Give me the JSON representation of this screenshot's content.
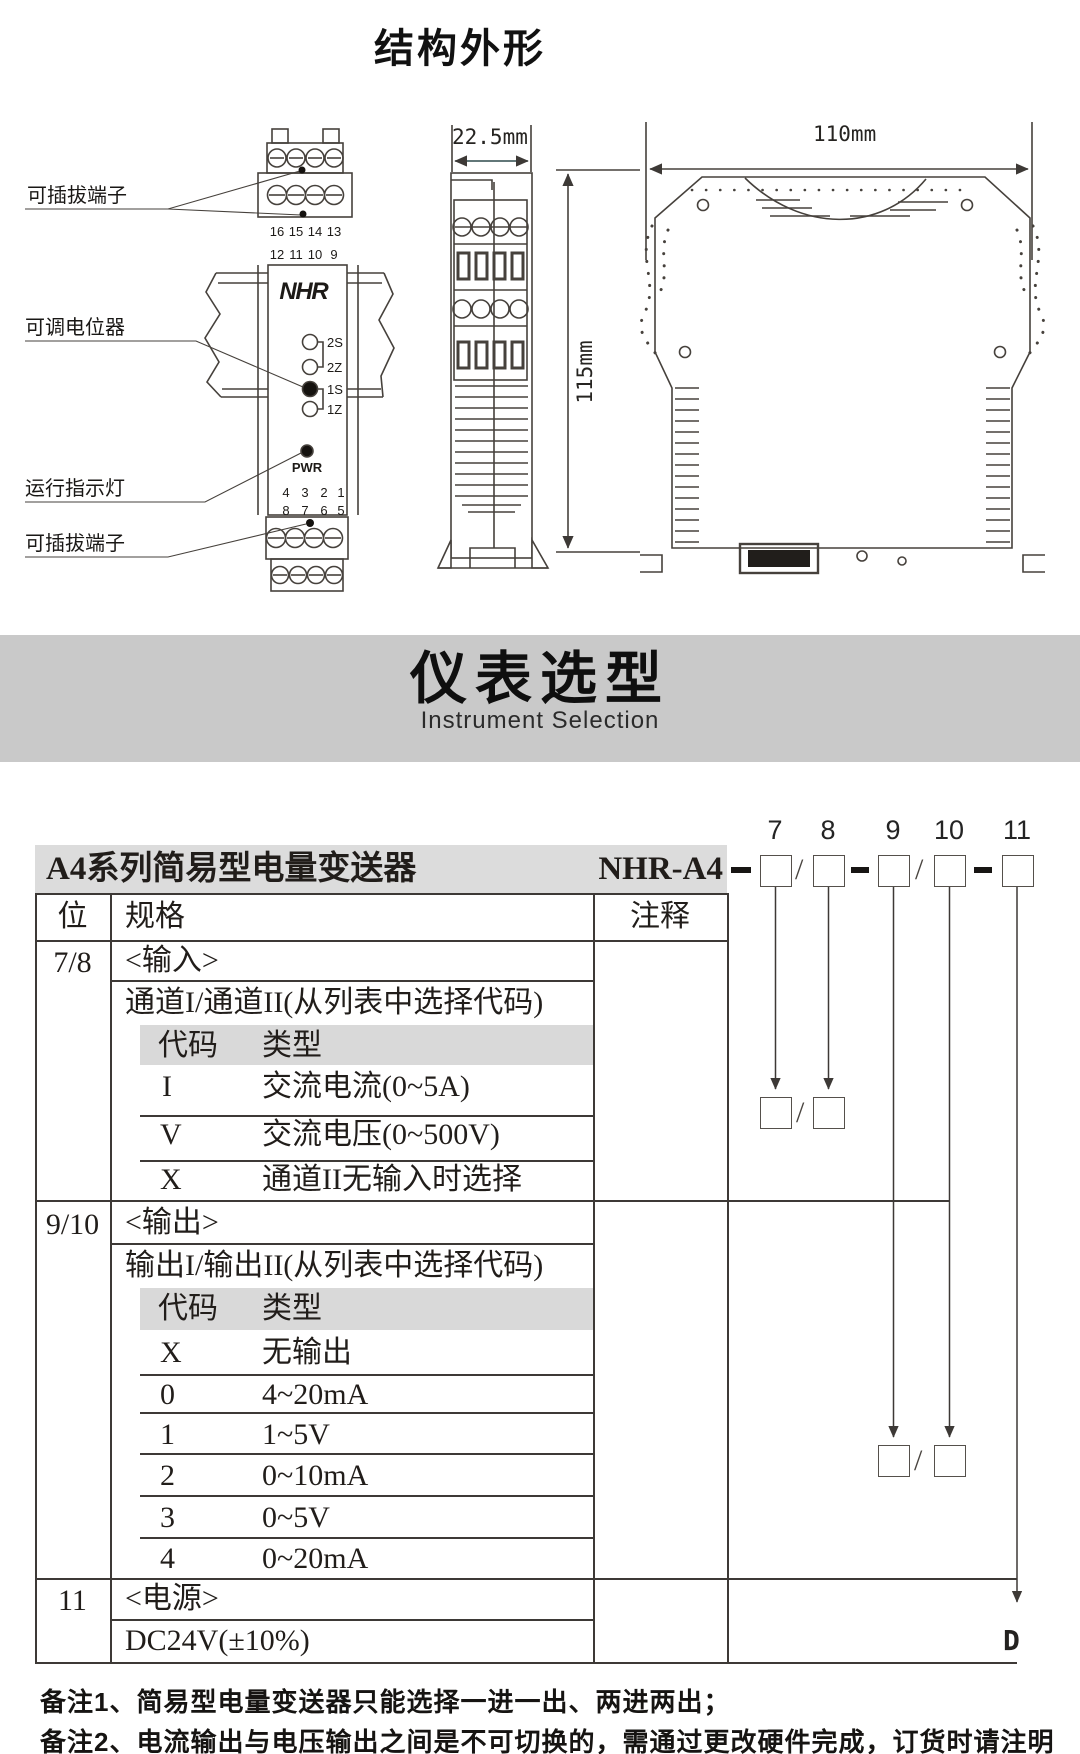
{
  "page": {
    "title": "结构外形"
  },
  "banner": {
    "title": "仪表选型",
    "subtitle": "Instrument Selection",
    "bg": "#c9c9c9"
  },
  "diagram": {
    "labels": {
      "pluggable_top": "可插拔端子",
      "potentiometer": "可调电位器",
      "indicator": "运行指示灯",
      "pluggable_bottom": "可插拔端子"
    },
    "dimensions": {
      "side_width": "22.5mm",
      "height": "115mm",
      "front_width": "110mm"
    },
    "front": {
      "brand": [
        "N",
        "H",
        "R"
      ],
      "brand_accent": "#d42a20",
      "top_row1": [
        "16",
        "15",
        "14",
        "13"
      ],
      "top_row2": [
        "12",
        "11",
        "10",
        "9"
      ],
      "leds": [
        "2S",
        "2Z",
        "1S",
        "1Z"
      ],
      "pwr": "PWR",
      "bottom_row1": [
        "4",
        "3",
        "2",
        "1"
      ],
      "bottom_row2": [
        "8",
        "7",
        "6",
        "5"
      ],
      "red_terminal_color": "#d42a20"
    }
  },
  "selection": {
    "product": "A4系列简易型电量变送器",
    "model": "NHR-A4",
    "positions": [
      "7",
      "8",
      "9",
      "10",
      "11"
    ],
    "slash": "/",
    "headers": {
      "pos": "位",
      "spec": "规格",
      "note": "注释"
    },
    "sections": [
      {
        "pos": "7/8",
        "title": "<输入>",
        "subtitle": "通道I/通道II(从列表中选择代码)",
        "col_code": "代码",
        "col_type": "类型",
        "rows": [
          {
            "code": "I",
            "type": "交流电流(0~5A)"
          },
          {
            "code": "V",
            "type": "交流电压(0~500V)"
          },
          {
            "code": "X",
            "type": "通道II无输入时选择"
          }
        ]
      },
      {
        "pos": "9/10",
        "title": "<输出>",
        "subtitle": "输出I/输出II(从列表中选择代码)",
        "col_code": "代码",
        "col_type": "类型",
        "rows": [
          {
            "code": "X",
            "type": "无输出"
          },
          {
            "code": "0",
            "type": "4~20mA"
          },
          {
            "code": "1",
            "type": "1~5V"
          },
          {
            "code": "2",
            "type": "0~10mA"
          },
          {
            "code": "3",
            "type": "0~5V"
          },
          {
            "code": "4",
            "type": "0~20mA"
          }
        ]
      },
      {
        "pos": "11",
        "title": "<电源>",
        "value": "DC24V(±10%)"
      }
    ],
    "power_code": "D",
    "notes": [
      "备注1、简易型电量变送器只能选择一进一出、两进两出；",
      "备注2、电流输出与电压输出之间是不可切换的，需通过更改硬件完成，订货时请注明"
    ]
  }
}
